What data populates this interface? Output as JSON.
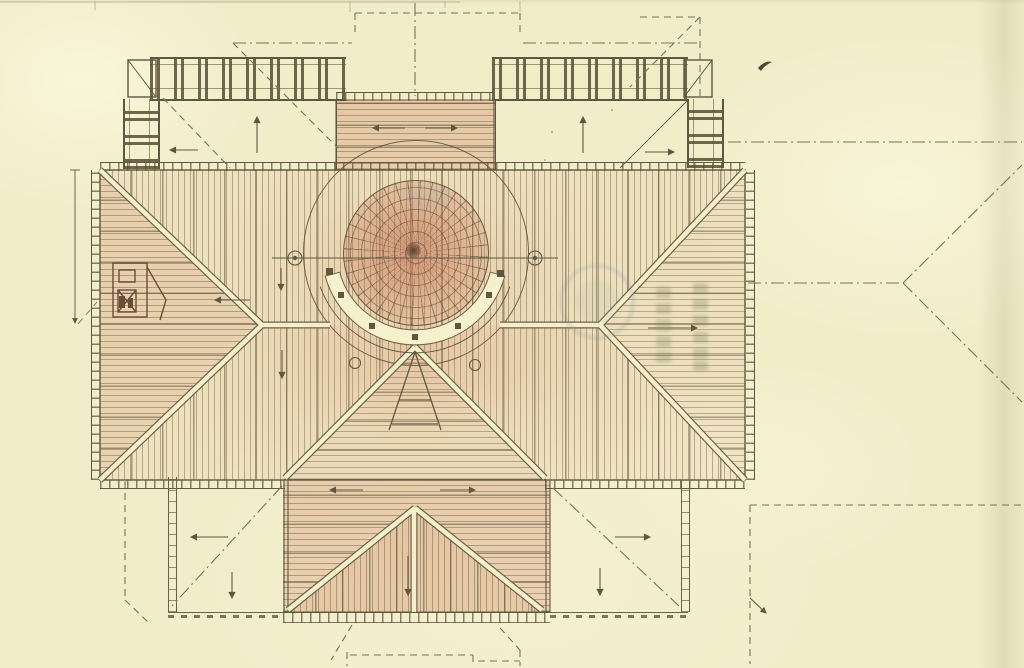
{
  "figure": {
    "drawing_type": "roof plan (hand-drawn, tinted)",
    "visible_text": [],
    "palette": {
      "paper": "#f2edc9",
      "ink": "#5f5740",
      "hatch_line": "#8a7f5c",
      "tile_wash": "#cf9477",
      "projection_dash": "#7b7257",
      "stamp_blue": "#7f93a0",
      "stamp_olive": "#7f8560"
    },
    "features": [
      "hipped-main-roof-with-batten-hatching",
      "central-dome-with-radial-ribs",
      "semicircular-gallery-below-dome",
      "north-porch-bay-roof",
      "south-wing-hip-roof",
      "roof-terraces-with-balustrades",
      "dashed-lower-floor-projection-lines",
      "drainage-direction-arrows",
      "faint-circular-stamp-illegible",
      "faint-seal-character-columns-illegible",
      "small-dormer-sketch",
      "ink-fleck"
    ],
    "arrows": [
      {
        "area": "nw-terrace",
        "directions": [
          "left",
          "up"
        ]
      },
      {
        "area": "ne-terrace",
        "directions": [
          "up",
          "right"
        ]
      },
      {
        "area": "north-bay",
        "directions": [
          "left",
          "right"
        ]
      },
      {
        "area": "west-face",
        "directions": [
          "left"
        ]
      },
      {
        "area": "east-face",
        "directions": [
          "right"
        ]
      },
      {
        "area": "north-face",
        "directions": [
          "down"
        ]
      },
      {
        "area": "south-face",
        "directions": [
          "down"
        ]
      },
      {
        "area": "south-wing",
        "directions": [
          "left",
          "right",
          "down"
        ]
      },
      {
        "area": "sw-terrace",
        "directions": [
          "left",
          "down"
        ]
      },
      {
        "area": "se-terrace",
        "directions": [
          "right",
          "down"
        ]
      },
      {
        "area": "left-margin-dimension",
        "directions": [
          "down"
        ]
      }
    ],
    "stamps": [
      {
        "shape": "circle",
        "legible": false
      },
      {
        "shape": "vertical-character-columns",
        "legible": false
      }
    ]
  }
}
